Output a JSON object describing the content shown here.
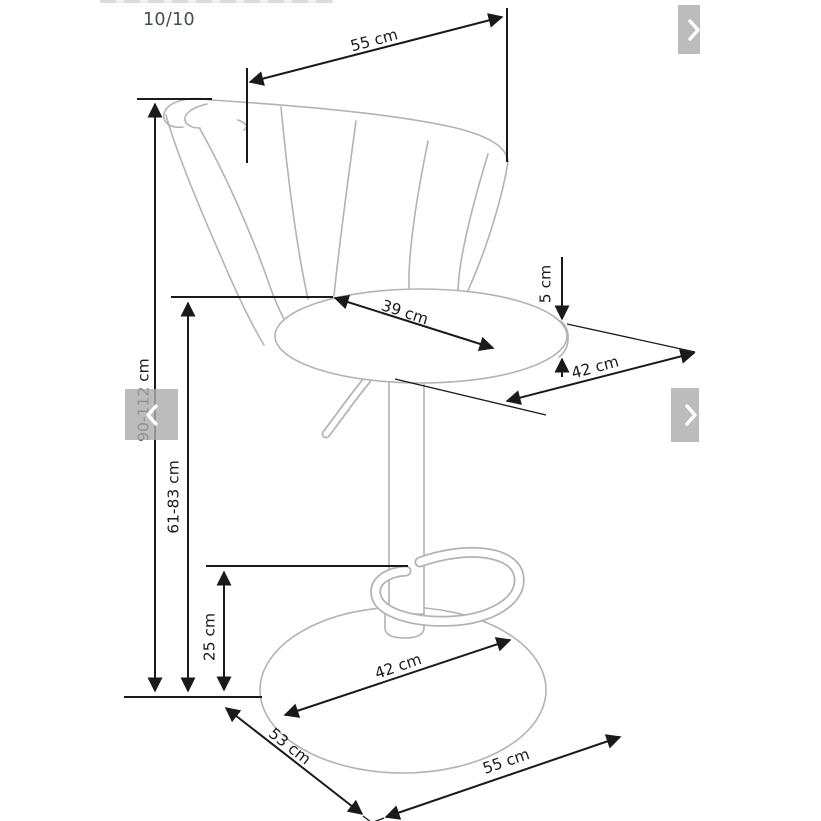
{
  "gallery": {
    "counter": "10/10",
    "nav": {
      "prev_icon": "chevron-left",
      "next_icon": "chevron-right",
      "corner_icon": "chevron-right"
    }
  },
  "diagram": {
    "subject": "bar stool dimension drawing",
    "dimensions": {
      "backrest_width": "55 cm",
      "seat_surface_depth": "39 cm",
      "seat_edge_thickness": "5 cm",
      "seat_total_depth": "42 cm",
      "total_height": "90-112 cm",
      "seat_height": "61-83 cm",
      "footrest_height": "25 cm",
      "base_width": "42 cm",
      "base_side": "53 cm",
      "base_front": "55 cm"
    },
    "colors": {
      "outline_gray": "#b3b3b3",
      "dimension_black": "#1a1a1a",
      "nav_button_gray": "#c4c4c4"
    }
  }
}
